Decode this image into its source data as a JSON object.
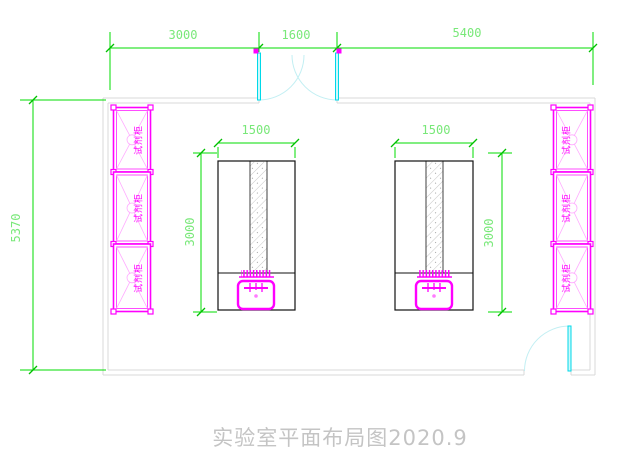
{
  "title": {
    "text": "实验室平面布局图2020.9"
  },
  "dims": {
    "top": [
      {
        "label": "3000"
      },
      {
        "label": "1600"
      },
      {
        "label": "5400"
      }
    ],
    "left": {
      "label": "5370"
    },
    "bench_left": {
      "width": "1500",
      "depth": "3000"
    },
    "bench_right": {
      "width": "1500",
      "depth": "3000"
    }
  },
  "cabinets": {
    "label": "试剂柜",
    "left_count": 3,
    "right_count": 3
  },
  "symbols": {
    "top_door": "double-swing-door",
    "bottom_door": "single-swing-door",
    "sink": "lab-sink-with-drainer"
  },
  "colors": {
    "dimension_line": "#00dc00",
    "dimension_text": "#79e879",
    "wall": "#d9d9d9",
    "cabinet": "#ff00ff",
    "cabinet_detail": "#ffaaff",
    "door": "#00d9e9",
    "door_swing": "#c2eff3",
    "bench_outline": "#111111",
    "title_text": "#c4c4c4"
  }
}
